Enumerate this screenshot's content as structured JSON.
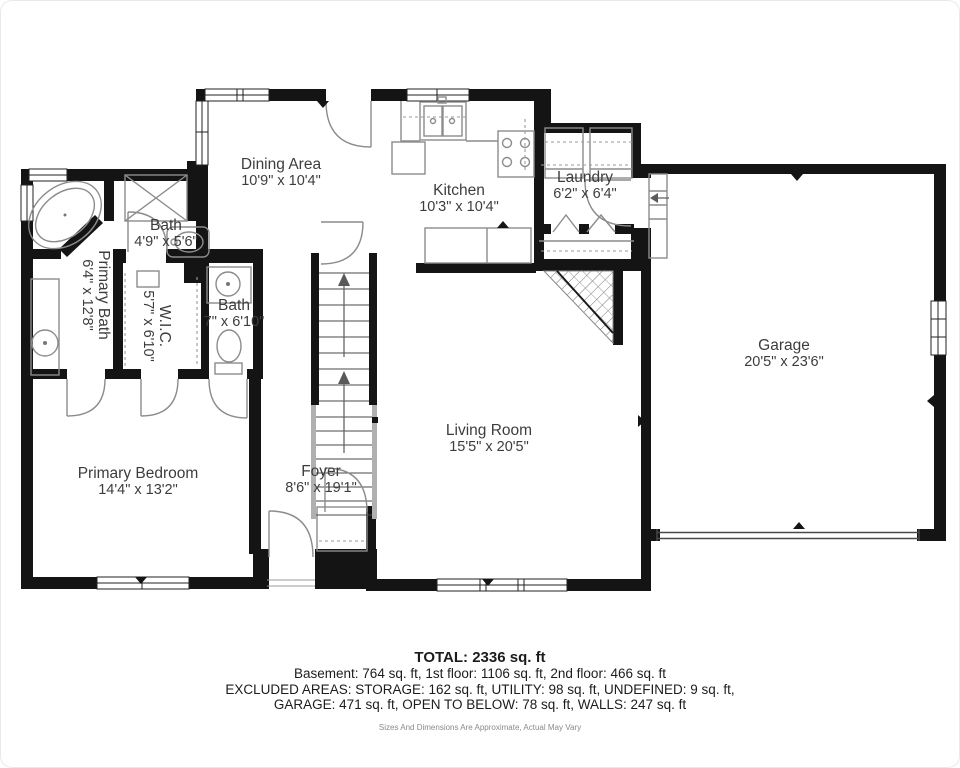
{
  "plan": {
    "rooms": [
      {
        "name": "Dining Area",
        "dims": "10'9\" x 10'4\""
      },
      {
        "name": "Kitchen",
        "dims": "10'3\" x 10'4\""
      },
      {
        "name": "Laundry",
        "dims": "6'2\" x 6'4\""
      },
      {
        "name": "Bath",
        "dims": "4'9\" x 5'6\""
      },
      {
        "name": "Primary Bath",
        "dims": "6'4\" x 12'8\""
      },
      {
        "name": "W.I.C.",
        "dims": "5'7\" x 6'10\""
      },
      {
        "name": "Bath",
        "dims": "7\" x 6'10\""
      },
      {
        "name": "Primary Bedroom",
        "dims": "14'4\" x 13'2\""
      },
      {
        "name": "Foyer",
        "dims": "8'6\" x 19'1\""
      },
      {
        "name": "Living Room",
        "dims": "15'5\" x 20'5\""
      },
      {
        "name": "Garage",
        "dims": "20'5\" x 23'6\""
      }
    ]
  },
  "summary": {
    "total": "TOTAL: 2336 sq. ft",
    "line1": "Basement: 764 sq. ft, 1st floor: 1106 sq. ft, 2nd floor: 466 sq. ft",
    "line2": "EXCLUDED AREAS: STORAGE: 162 sq. ft, UTILITY: 98 sq. ft, UNDEFINED: 9 sq. ft,",
    "line3": "GARAGE: 471 sq. ft, OPEN TO BELOW: 78 sq. ft, WALLS: 247 sq. ft",
    "disclaimer": "Sizes And Dimensions Are Approximate, Actual May Vary"
  },
  "colors": {
    "wall": "#141414",
    "fixture": "#8c8c8c",
    "text": "#3d3d3d"
  }
}
